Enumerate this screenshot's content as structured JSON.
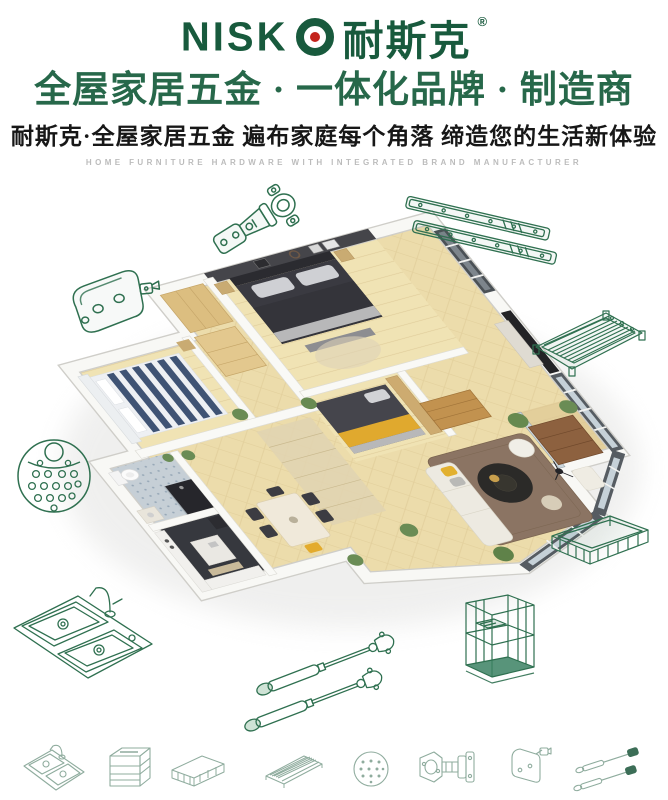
{
  "brand": {
    "latin": "NISK",
    "logo_o_icon": "target-ring-with-red-dot",
    "cn": "耐斯克",
    "registered": "®"
  },
  "header": {
    "headline": "全屋家居五金 · 一体化品牌 · 制造商",
    "subheadline": "耐斯克·全屋家居五金  遍布家庭每个角落  缔造您的生活新体验",
    "tagline_en": "HOME FURNITURE HARDWARE WITH INTEGRATED BRAND MANUFACTURER"
  },
  "center_visual": "3d-isometric-apartment-cutaway-render",
  "products_lineart": [
    "concealed-cabinet-hinge",
    "telescopic-drawer-slides",
    "corner-connector-bracket",
    "wire-shelf-rack",
    "perforated-round-plate",
    "double-bowl-kitchen-sink-with-faucet",
    "wire-storage-basket",
    "wire-storage-cage",
    "gas-lift-struts"
  ],
  "bottom_icons": [
    "double-sink-icon",
    "pullout-basket-icon",
    "wire-basket-icon",
    "wire-rack-icon",
    "perforated-plate-icon",
    "cabinet-hinge-icon",
    "connector-bracket-icon",
    "gas-struts-icon"
  ],
  "colors": {
    "brand_green": "#185a3d",
    "headline_green": "#27684a",
    "logo_dot_red": "#c3231c",
    "lineart_green": "#2f7050",
    "icon_muted_green": "#8fac9e",
    "subhead_dark": "#171717",
    "tagline_gray": "#bcbcbc",
    "floor_wood": "#ecdcab",
    "accent_wall": "#45454a",
    "accent_yellow": "#e0a92e"
  }
}
